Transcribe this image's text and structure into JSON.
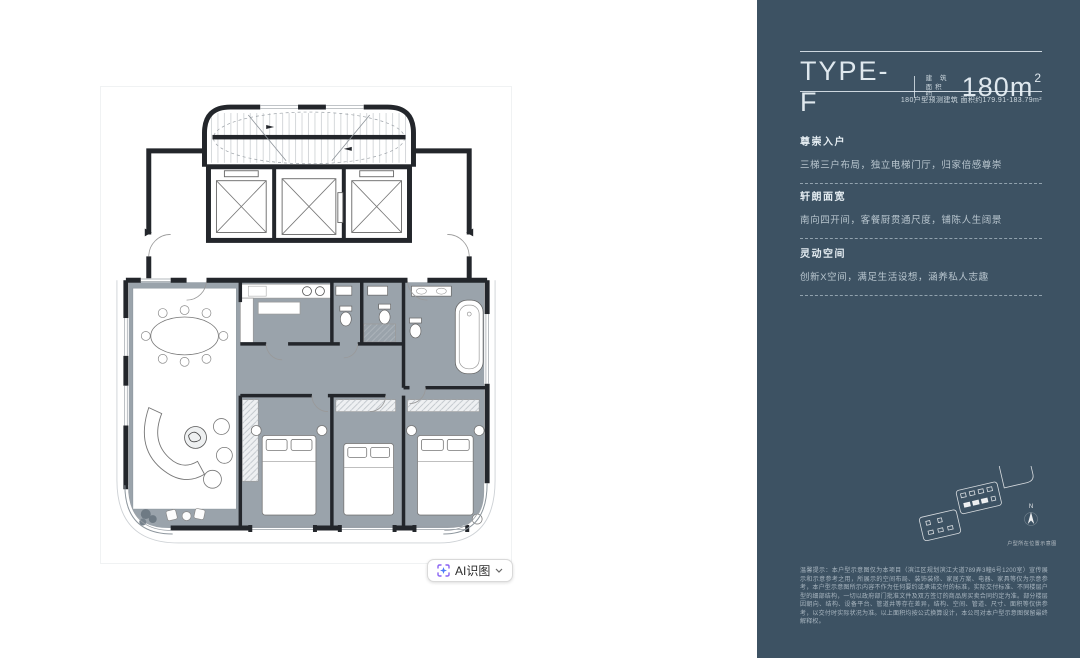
{
  "panel": {
    "bg_color": "#3d5263",
    "title": "TYPE-F",
    "area_unit_label_line1": "建 筑",
    "area_unit_label_line2": "面积约",
    "area_value": "180m",
    "area_superscript": "2",
    "subtitle": "180户型预测建筑 面积约179.91-183.79m²",
    "sections": [
      {
        "heading": "尊崇入户",
        "body": "三梯三户布局，独立电梯门厅，归家倍感尊崇"
      },
      {
        "heading": "轩朗面宽",
        "body": "南向四开间，客餐厨贯通尺度，铺陈人生阔景"
      },
      {
        "heading": "灵动空间",
        "body": "创新X空间，满足生活设想，涵养私人志趣"
      }
    ],
    "compass_label": "N",
    "locator_caption": "户型所在位置示意图",
    "disclaimer": "温馨提示：本户型示意图仅为本项目（滨江区规划滨江大道789弄3幢6号1200室）宣传展示和示意参考之用，所展示的空间布局、装饰装修、家居方案、电器、家具等仅为示意参考，本户型示意图所示内容不作为任何要约或承诺交付的标准，实际交付标准、不同楼层户型的细部结构，一切以政府部门批准文件及双方签订的商品房买卖合同约定为准。部分楼层因朝向、结构、设备平台、管道井等存在差异，结构、空间、管道、尺寸、面积等仅供参考，以交付时实际状况为准。以上面积均按公式换算设计，本公司对本户型示意图保留最终解释权。"
  },
  "floorplan": {
    "room_fill_color": "#9aa3ab",
    "wall_color": "#23262b"
  },
  "ai_button": {
    "label": "AI识图",
    "accent_color": "#8a63f3"
  }
}
